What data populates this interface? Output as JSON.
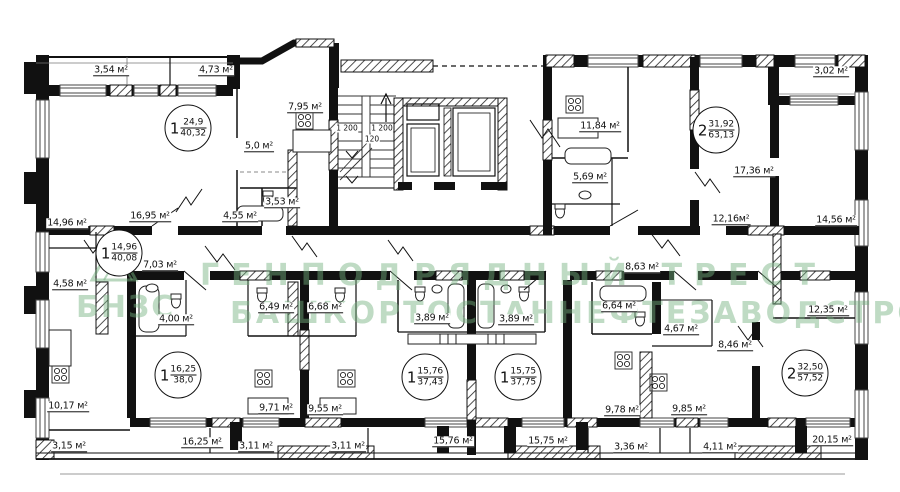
{
  "document": {
    "type": "residential floor plan",
    "background": "#ffffff",
    "line_color": "#111111",
    "watermark_color": "#74b07e"
  },
  "watermark": {
    "logo_text": "БНЗС",
    "line1": "ГЕНПОДРЯДНЫЙ ТРЕСТ",
    "line2": "БАШКОРТОСТАННЕФТЕЗАВОДСТРОЙ"
  },
  "apartments": [
    {
      "rooms_count": "1",
      "living_area": "24,9",
      "total_area": "40,32"
    },
    {
      "rooms_count": "2",
      "living_area": "31,92",
      "total_area": "63,13"
    },
    {
      "rooms_count": "1",
      "living_area": "14,96",
      "total_area": "40,08"
    },
    {
      "rooms_count": "1",
      "living_area": "16,25",
      "total_area": "38,0"
    },
    {
      "rooms_count": "1",
      "living_area": "15,76",
      "total_area": "37,43"
    },
    {
      "rooms_count": "1",
      "living_area": "15,75",
      "total_area": "37,75"
    },
    {
      "rooms_count": "2",
      "living_area": "32,50",
      "total_area": "57,52"
    }
  ],
  "room_areas": {
    "apt1_top_left": [
      "3,54 м²",
      "4,73 м²",
      "7,95 м²",
      "5,0 м²",
      "3,53 м²",
      "4,55 м²",
      "16,95 м²"
    ],
    "apt3_left": [
      "14,96 м²",
      "7,03 м²",
      "4,58 м²",
      "4,00 м²",
      "10,17 м²",
      "3,15 м²"
    ],
    "apt2_top_right": [
      "11,84 м²",
      "5,69 м²",
      "3,02 м²",
      "17,36 м²",
      "12,16м²",
      "14,56 м²"
    ],
    "apt4_bottom_left": [
      "6,49 м²",
      "6,68 м²",
      "9,71 м²",
      "9,55 м²",
      "16,25 м²",
      "3,11 м²"
    ],
    "apt5_apt6_middle": [
      "3,89 м²",
      "3,89 м²",
      "3,11 м²",
      "15,76 м²",
      "15,75 м²"
    ],
    "apt7_bottom_right": [
      "8,63 м²",
      "6,64 м²",
      "4,67 м²",
      "8,46 м²",
      "12,35 м²",
      "9,78 м²",
      "9,85 м²",
      "3,36 м²",
      "4,11 м²",
      "20,15 м²"
    ]
  },
  "stair_dimensions": [
    "1 200",
    "1 200",
    "120"
  ]
}
